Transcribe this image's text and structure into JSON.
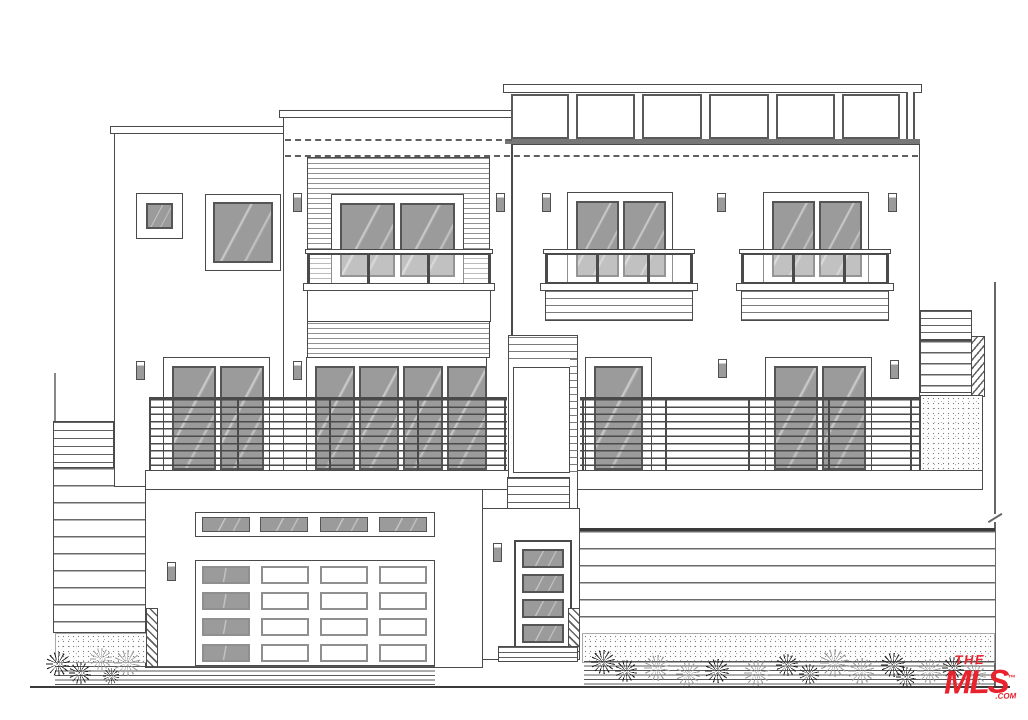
{
  "logo": {
    "line1": "THE",
    "line2": "MLS",
    "trademark": "™",
    "suffix": ".COM",
    "color": "#e8232e"
  },
  "colors": {
    "background": "#ffffff",
    "ink": "#4a4a4a",
    "glass": "#9b9b9b",
    "glass_light": "#c2c2c2",
    "logo_red": "#e8232e"
  },
  "scene": {
    "drawing_type": "house front elevation line drawing",
    "stories": 3,
    "roof_deck_glass_panels": 6,
    "juliet_balconies": 3,
    "third_floor_window_units": 4,
    "second_floor_door_units": 4,
    "garage_door_grid_rows": 4,
    "garage_door_grid_cols": 4,
    "garage_clerestory_panes": 4,
    "entry_door_lites": 4,
    "wall_sconces": 12,
    "shrubs_left": 5,
    "shrubs_right": 15
  }
}
